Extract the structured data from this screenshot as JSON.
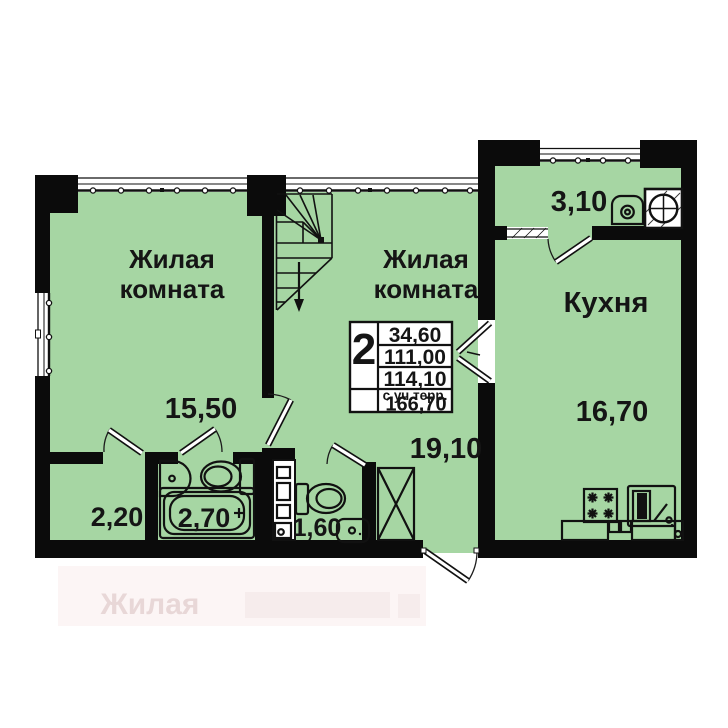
{
  "plan": {
    "rooms": [
      {
        "key": "living-room-1",
        "label_lines": [
          "Жилая",
          "комната"
        ],
        "area": "15,50"
      },
      {
        "key": "living-room-2",
        "label_lines": [
          "Жилая",
          "комната"
        ],
        "area": "19,10"
      },
      {
        "key": "kitchen",
        "label_lines": [
          "Кухня"
        ],
        "area": "16,70"
      },
      {
        "key": "terrace",
        "area": "3,10"
      },
      {
        "key": "hallway",
        "area": "2,20"
      },
      {
        "key": "bathroom",
        "area": "2,70"
      },
      {
        "key": "wc",
        "area": "1,60"
      }
    ],
    "info_table": {
      "rooms_count": "2",
      "area_living": "34,60",
      "area_row2": "111,00",
      "area_row3": "114,10",
      "terrace_note": "с уч.терр.",
      "area_with_terrace": "166,70"
    },
    "watermark_text": "Жилая",
    "colors": {
      "room_fill": "#a6d6a3",
      "wall": "#0b0b0b",
      "line": "#1c1c1c"
    }
  }
}
